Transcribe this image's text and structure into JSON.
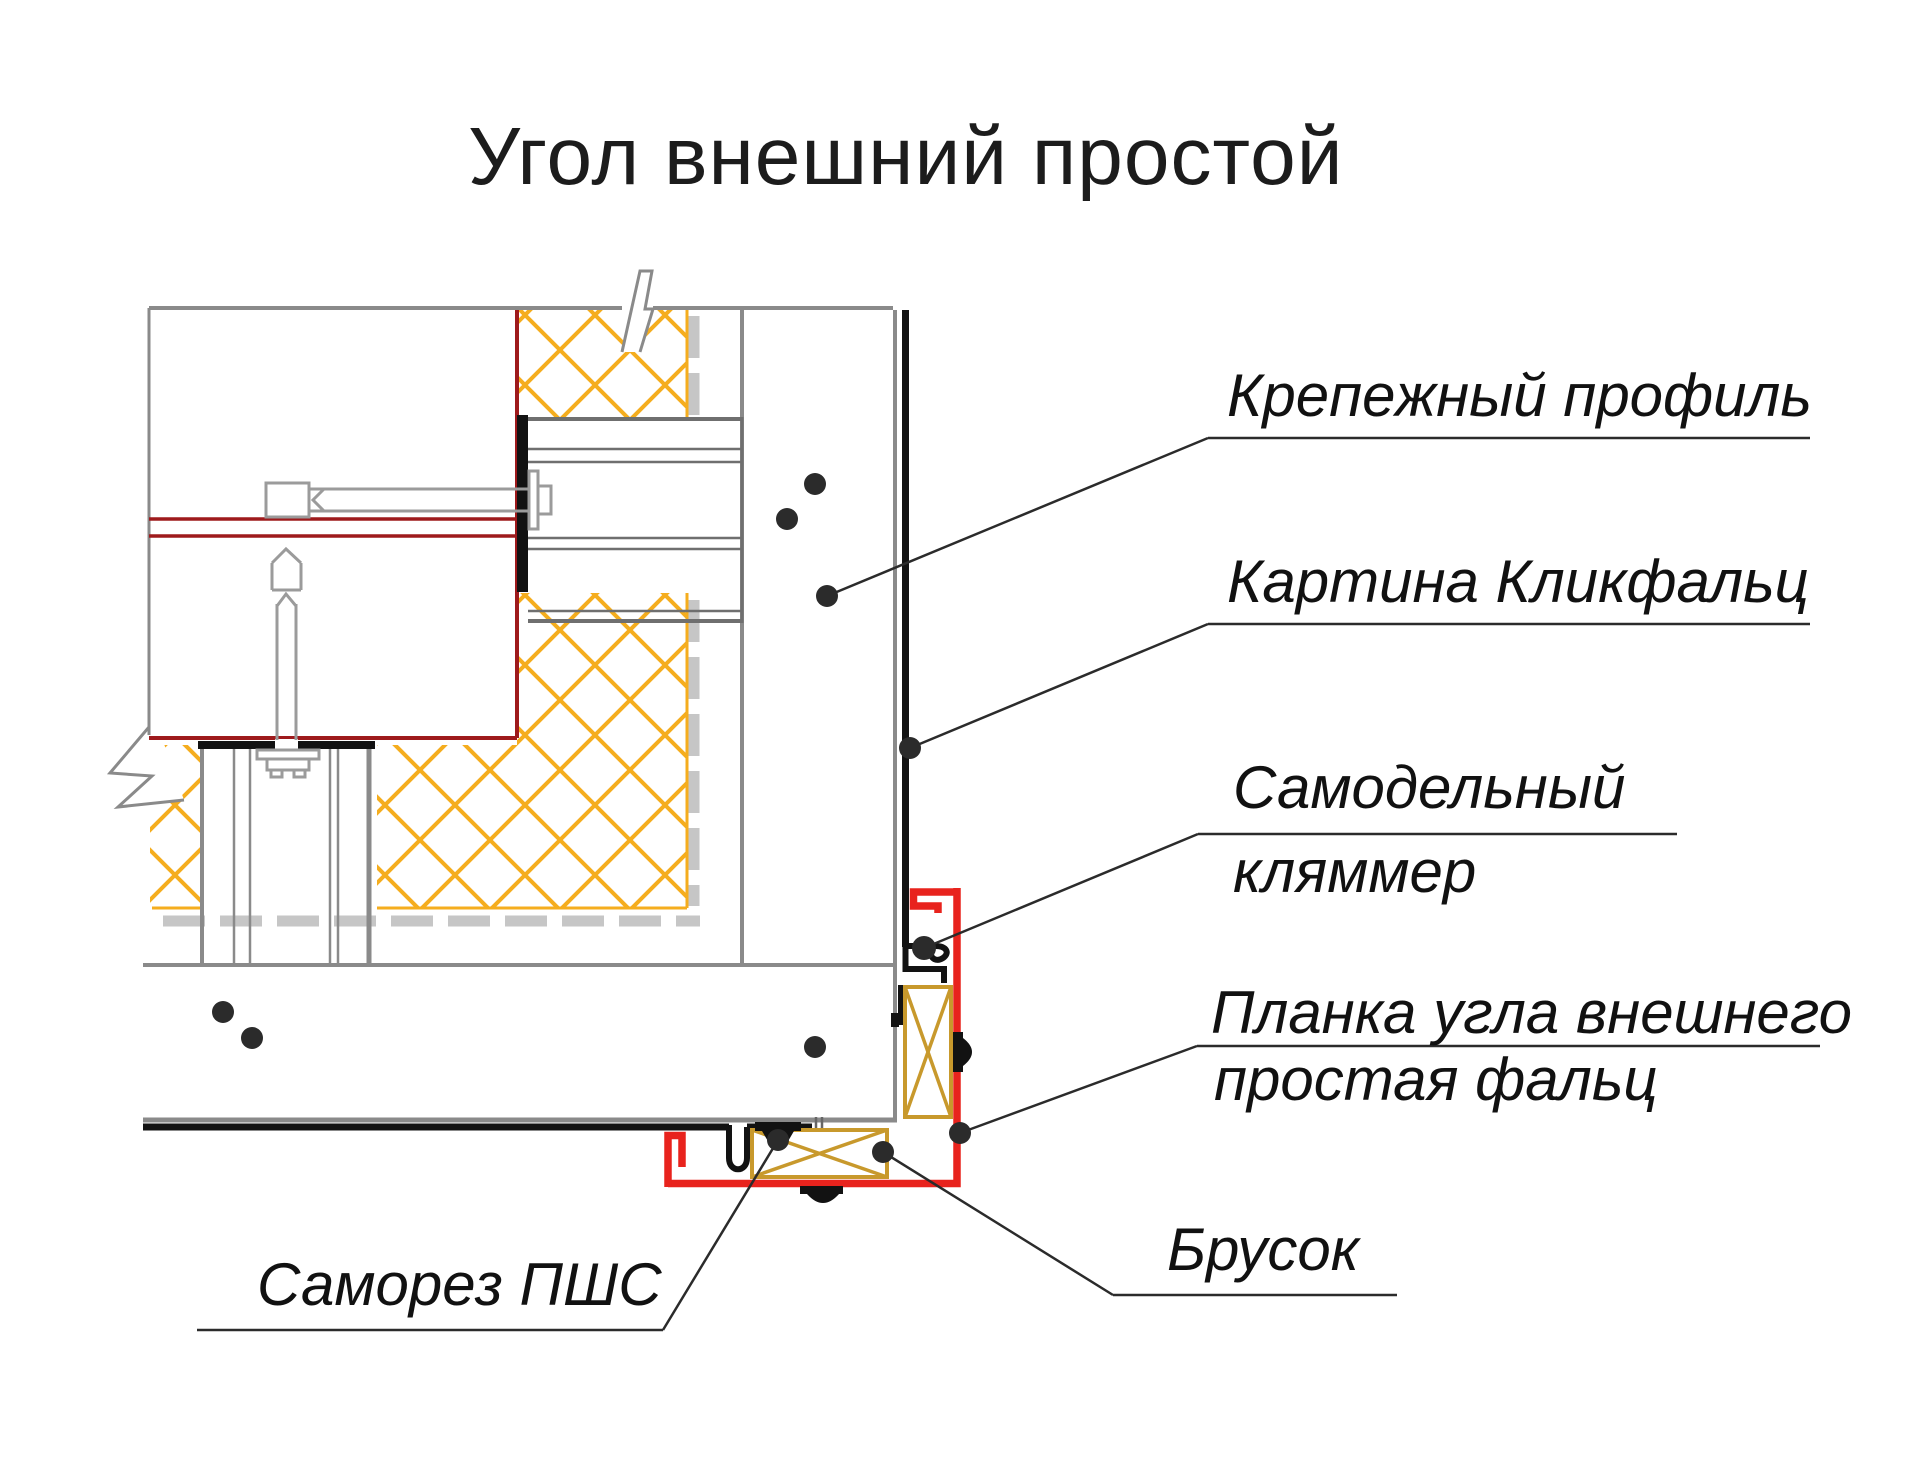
{
  "title": "Угол внешний простой",
  "labels": {
    "fastening_profile": {
      "text": "Крепежный профиль"
    },
    "klickfalz_panel": {
      "text": "Картина Кликфальц"
    },
    "homemade_clamp": {
      "line1": "Самодельный",
      "line2": "кляммер"
    },
    "corner_strip": {
      "line1": "Планка угла внешнего",
      "line2": "простая фальц"
    },
    "wood_block": {
      "text": "Брусок"
    },
    "screw": {
      "text": "Саморез ПШС"
    }
  },
  "colors": {
    "red": "#e8231d",
    "dark_red": "#9e1a1c",
    "insulation_yellow": "#f5ad1e",
    "wood_tan": "#c8992c",
    "wall_gray": "#8a8a8a",
    "strip_gray": "#c6c6c6",
    "profile_gray": "#6f6f6f",
    "hardware_gray": "#9b9b9b",
    "panel_black": "#121212",
    "leader_black": "#2b2b2b"
  }
}
